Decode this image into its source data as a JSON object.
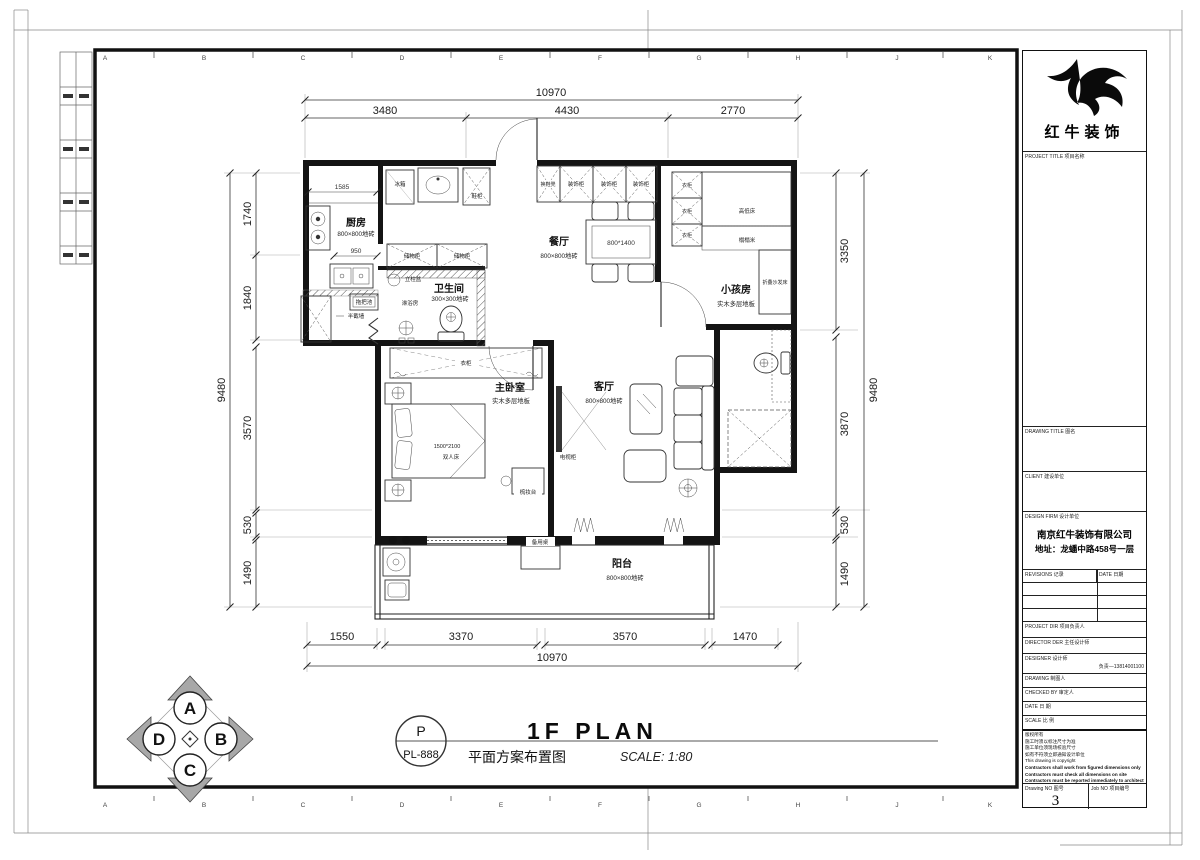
{
  "sheet": {
    "grid_letters": [
      "A",
      "B",
      "C",
      "D",
      "E",
      "F",
      "G",
      "H",
      "J",
      "K"
    ]
  },
  "dims": {
    "top": {
      "overall": "10970",
      "segments": [
        "3480",
        "4430",
        "2770"
      ]
    },
    "bottom": {
      "overall": "10970",
      "segments": [
        "1550",
        "3370",
        "3570",
        "1470"
      ]
    },
    "left": {
      "overall": "9480",
      "segments": [
        "1740",
        "1840",
        "3570",
        "530",
        "1490"
      ]
    },
    "right": {
      "overall": "9480",
      "segments": [
        "3350",
        "3870",
        "530",
        "1490"
      ]
    },
    "kitchen": {
      "width": "1585",
      "counter": "950"
    }
  },
  "rooms": {
    "kitchen": {
      "name": "厨房",
      "floor": "800×800地砖"
    },
    "dining": {
      "name": "餐厅",
      "floor": "800×800地砖"
    },
    "kids": {
      "name": "小孩房",
      "floor": "实木多层地板"
    },
    "bath": {
      "name": "卫生间",
      "floor": "300×300地砖"
    },
    "master": {
      "name": "主卧室",
      "floor": "实木多层地板"
    },
    "living": {
      "name": "客厅",
      "floor": "800×800地砖"
    },
    "balcony": {
      "name": "阳台",
      "floor": "800×800地砖"
    }
  },
  "furniture": {
    "fridge": "冰箱",
    "shoe_cabinet": "鞋柜",
    "shoe_bench": "换鞋凳",
    "deco_cabinet": "装饰柜",
    "storage_cabinet": "储物柜",
    "pedestal_basin": "立柱盆",
    "shower_room": "淋浴房",
    "mop_pool": "拖把池",
    "half_wall": "半截墙",
    "wardrobe": "衣柜",
    "bunk_bed": "高低床",
    "tatami": "榻榻米",
    "folding_sofa_bed": "折叠沙发床",
    "bed_size": "1500*2100",
    "double_bed": "双人床",
    "table_size": "800*1400",
    "tv_cabinet": "电视柜",
    "dresser": "梳妆台",
    "spare_table": "备用桌"
  },
  "titleblock": {
    "brand": "红牛装饰",
    "project_title": "PROJECT TITLE  项目名称",
    "drawing_title": "DRAWING TITLE  图名",
    "client": "CLIENT  建设单位",
    "design_firm": "DESIGN FIRM  设计单位",
    "firm_name": "南京红牛装饰有限公司",
    "firm_address": "地址：龙蟠中路458号一层",
    "revisions": "REVISIONS  记录",
    "date_col": "DATE  日期",
    "project_dir": "PROJECT DIR  项目负责人",
    "director": "DIRECTOR DER  主任设计师",
    "designer": "DESIGNER  设计师",
    "designer_phone": "负责—13814001100",
    "drawing": "DRAWING  制图人",
    "checked": "CHECKED BY  审定人",
    "date": "DATE  日 期",
    "scale": "SCALE  比 例",
    "notes": [
      "版权所有",
      "施工时须以标注尺寸为准",
      "施工单位须现场校验尺寸",
      "如有不符须立即通知设计单位",
      "This drawing is copyright",
      "Contractors shall work from figured dimensions only",
      "Contractors must check all dimensions on site",
      "Contractors must be reported immediately to architects"
    ],
    "drawing_no_label": "Drawing NO  图号",
    "drawing_no": "3",
    "job_no_label": "Job NO  项目编号"
  },
  "footer": {
    "stamp_letter": "P",
    "stamp_code": "PL-888",
    "title_en": "1F PLAN",
    "title_cn": "平面方案布置图",
    "scale_note": "SCALE: 1:80"
  },
  "compass": {
    "top": "A",
    "right": "B",
    "bottom": "C",
    "left": "D"
  }
}
